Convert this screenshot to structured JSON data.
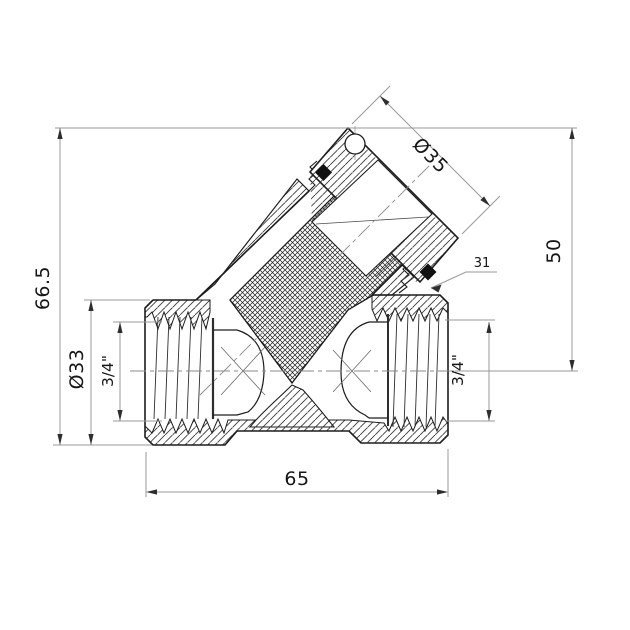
{
  "drawing": {
    "title": "Y-strainer filter valve technical drawing",
    "view": "sectional side view",
    "colors": {
      "background": "#ffffff",
      "part_line": "#1d1d1d",
      "hatch": "#3a3a3a",
      "dimension_line": "#999999",
      "dimension_text": "#161616",
      "seal_fill": "#111111"
    },
    "dimensions": {
      "total_height": "66.5",
      "body_outer_diameter": "Ø33",
      "left_port_thread": "3/4\"",
      "cap_diameter": "Ø35",
      "branch_height": "50",
      "hex_size": "31",
      "right_port_thread": "3/4\"",
      "total_length": "65"
    }
  }
}
